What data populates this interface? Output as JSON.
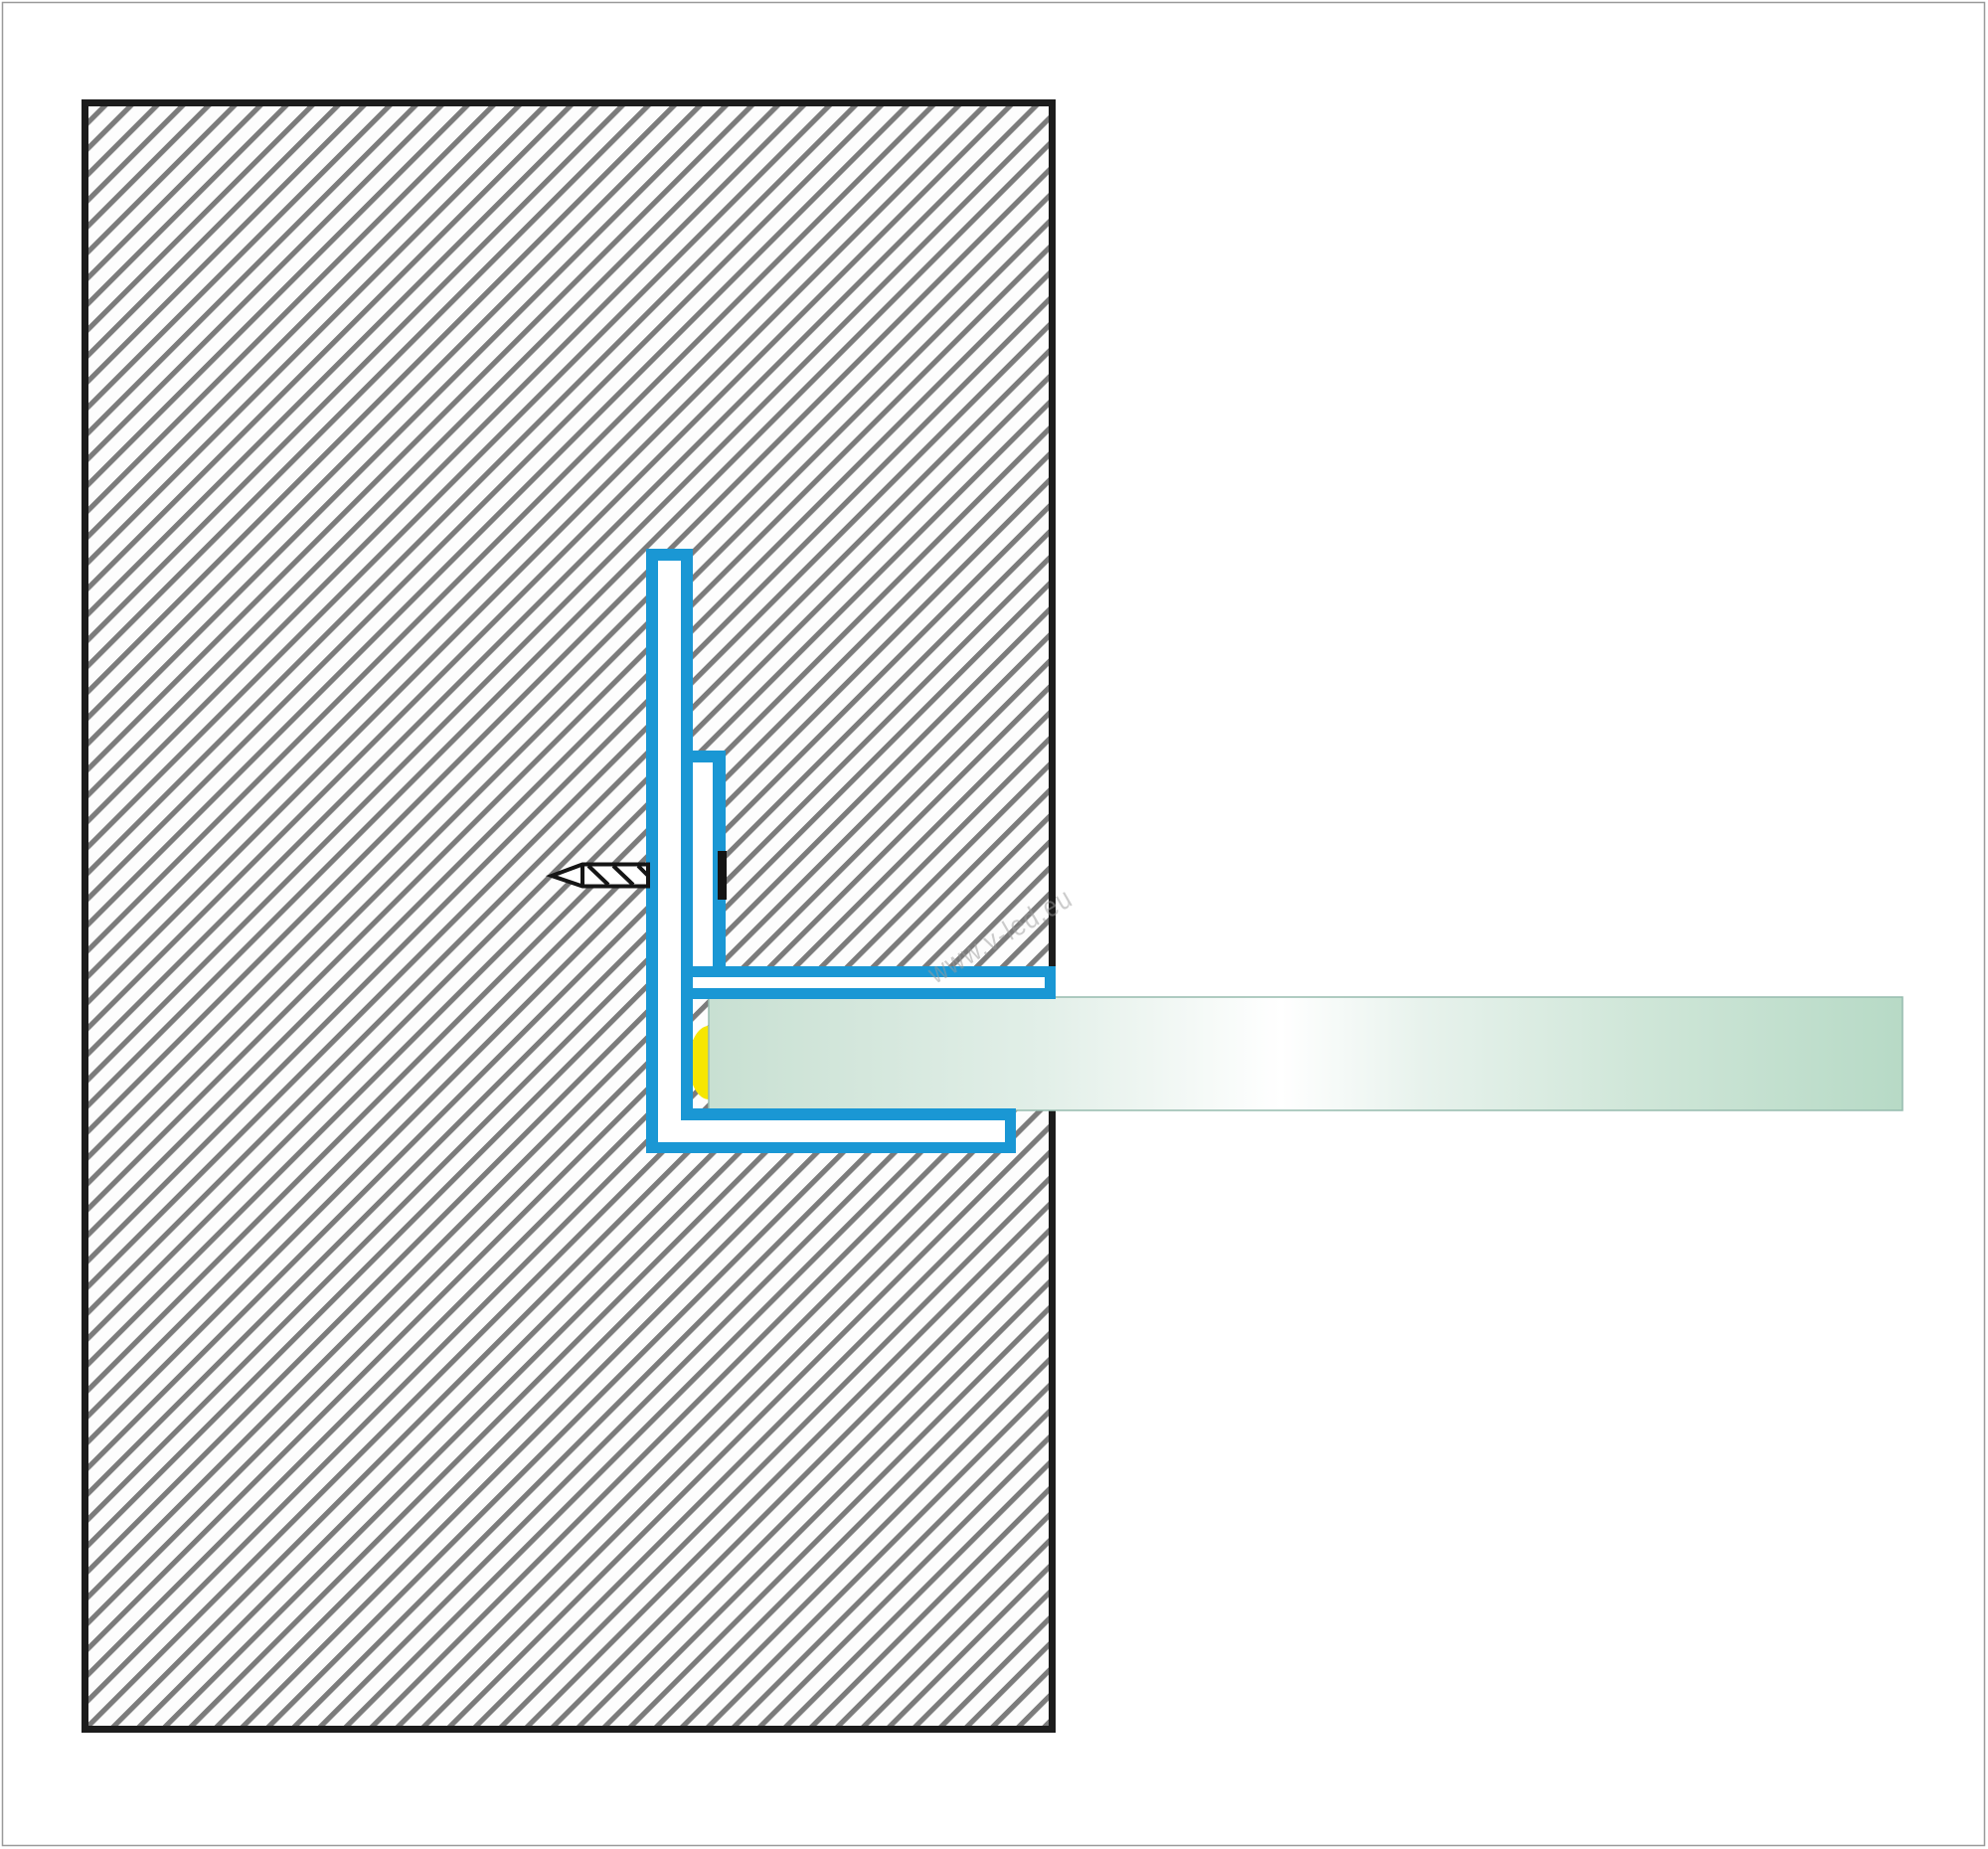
{
  "watermark": {
    "text": "www.v-led.eu"
  },
  "colors": {
    "page_background": "#ffffff",
    "page_border": "#9a9a9a",
    "wall_fill": "#fdfdfd",
    "wall_hatch_gray": "#7b7b7b",
    "wall_border_black": "#1c1c1c",
    "profile_blue": "#1a97d4",
    "profile_fill_white": "#ffffff",
    "screw_black": "#151515",
    "screw_fill": "#ffffff",
    "gasket_yellow": "#f6e600",
    "glass_edge": "#96bbae",
    "watermark_gray": "#9b9b9b",
    "glass_stops": {
      "s0": "#c8e0d2",
      "s1": "#e2efe8",
      "s2": "#ffffff",
      "s3": "#e7f2ec",
      "s4": "#cfe6d8",
      "s5": "#b7dac6"
    }
  }
}
